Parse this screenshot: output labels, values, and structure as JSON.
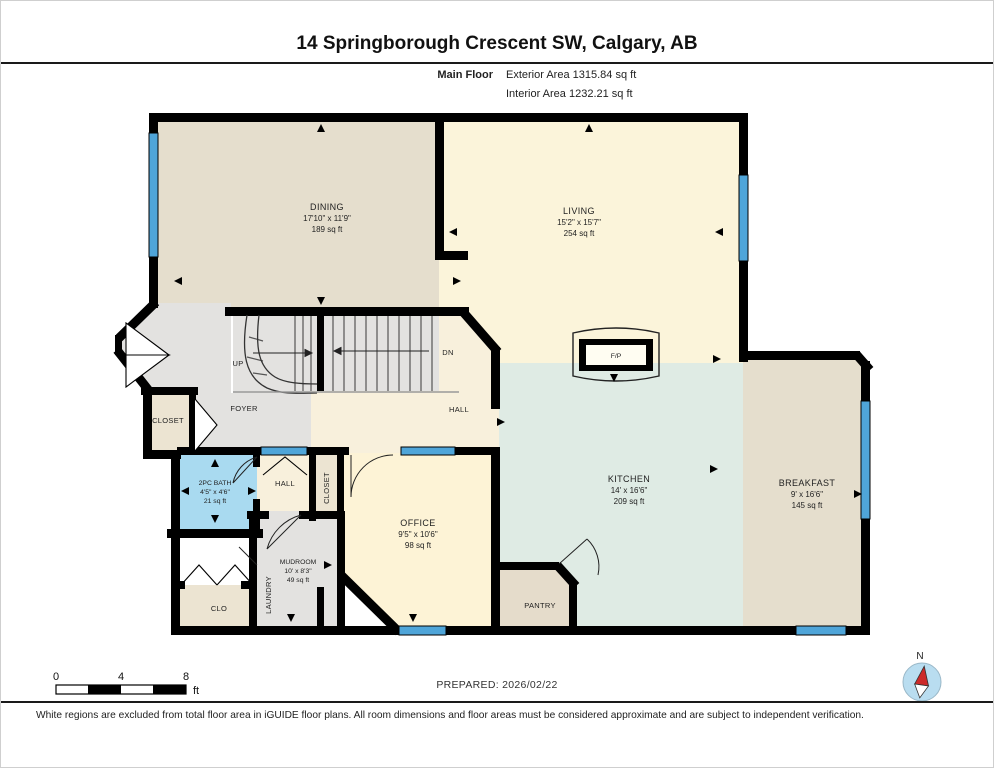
{
  "header": {
    "title": "14 Springborough Crescent SW, Calgary, AB",
    "floor_label": "Main Floor",
    "exterior_area": "Exterior Area 1315.84 sq ft",
    "interior_area": "Interior Area 1232.21 sq ft"
  },
  "rooms": {
    "dining": {
      "name": "DINING",
      "dims": "17'10\" x 11'9\"",
      "area": "189 sq ft"
    },
    "living": {
      "name": "LIVING",
      "dims": "15'2\" x 15'7\"",
      "area": "254 sq ft"
    },
    "kitchen": {
      "name": "KITCHEN",
      "dims": "14' x 16'6\"",
      "area": "209 sq ft"
    },
    "breakfast": {
      "name": "BREAKFAST",
      "dims": "9' x 16'6\"",
      "area": "145 sq ft"
    },
    "office": {
      "name": "OFFICE",
      "dims": "9'5\" x 10'6\"",
      "area": "98 sq ft"
    },
    "bath": {
      "name": "2PC BATH",
      "dims": "4'5\" x 4'6\"",
      "area": "21 sq ft"
    },
    "mudroom": {
      "name": "MUDROOM",
      "dims": "10' x 8'3\"",
      "area": "49 sq ft"
    },
    "foyer": {
      "name": "FOYER"
    },
    "hall_upper": {
      "name": "HALL"
    },
    "hall_lower": {
      "name": "HALL"
    },
    "closet_entry": {
      "name": "CLOSET"
    },
    "closet_hall": {
      "name": "CLOSET"
    },
    "pantry": {
      "name": "PANTRY"
    },
    "clo": {
      "name": "CLO"
    },
    "laundry": {
      "name": "LAUNDRY"
    }
  },
  "stairs": {
    "up_label": "UP",
    "down_label": "DN"
  },
  "fireplace_label": "F/P",
  "scale_bar": {
    "ticks": [
      "0",
      "4",
      "8"
    ],
    "unit": "ft"
  },
  "compass": {
    "north_label": "N"
  },
  "footer": {
    "prepared": "PREPARED: 2026/02/22",
    "disclaimer": "White regions are excluded from total floor area in iGUIDE floor plans. All room dimensions and floor areas must be considered approximate and are subject to independent verification."
  },
  "colors": {
    "wall": "#000000",
    "window": "#4fa5d9",
    "dining_breakfast_fill": "#e5decd",
    "living_fill": "#fbf4da",
    "office_fill": "#fdf3d6",
    "kitchen_fill": "#dfebe4",
    "bath_fill": "#a9daf0",
    "hall_fill": "#f8f0dc",
    "closet_fill": "#ece4d2",
    "gray_area_fill": "#e3e2e0",
    "compass_fill": "#b9ddf0",
    "compass_needle": "#cc2a2a"
  }
}
